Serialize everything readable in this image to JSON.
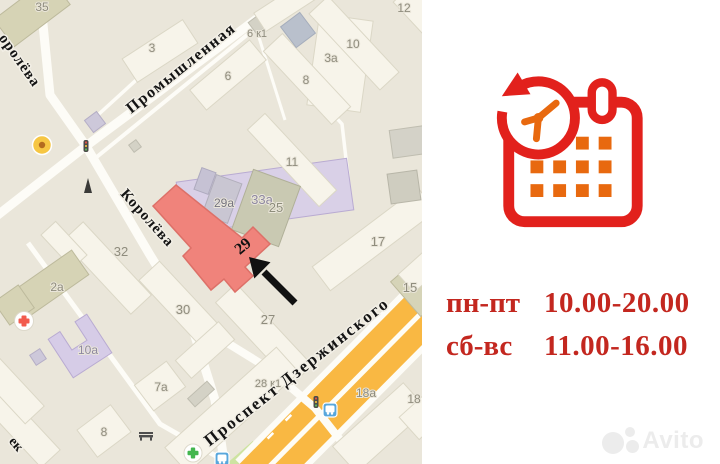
{
  "map": {
    "street_labels": [
      {
        "text": "Промышленная"
      },
      {
        "text": "Королёва"
      },
      {
        "text": "оролёва"
      },
      {
        "text": "Проспект Дзержинского"
      },
      {
        "text": "ек"
      }
    ],
    "building_labels": [
      {
        "text": "35"
      },
      {
        "text": "3а"
      },
      {
        "text": "3"
      },
      {
        "text": "6 к1"
      },
      {
        "text": "12"
      },
      {
        "text": "6"
      },
      {
        "text": "8"
      },
      {
        "text": "10"
      },
      {
        "text": "11"
      },
      {
        "text": "33а"
      },
      {
        "text": "29а"
      },
      {
        "text": "25"
      },
      {
        "text": "17"
      },
      {
        "text": "15"
      },
      {
        "text": "32"
      },
      {
        "text": "30"
      },
      {
        "text": "27"
      },
      {
        "text": "2а"
      },
      {
        "text": "10а"
      },
      {
        "text": "7а"
      },
      {
        "text": "8"
      },
      {
        "text": "28 к1"
      },
      {
        "text": "18а"
      },
      {
        "text": "18"
      }
    ],
    "highlight": {
      "label": "29",
      "color": "#f0837b"
    },
    "markers": [
      "cafe-marker",
      "monument-marker",
      "hospital-marker",
      "pharmacy-marker",
      "bus-stop-marker",
      "bus-stop-marker",
      "traffic-light-marker",
      "traffic-light-marker",
      "bench-marker"
    ],
    "colors": {
      "background": "#eae6da",
      "road": "#fdfcf7",
      "highway": "#f9b843",
      "building": "#f7f4ea",
      "green": "#cde3a1",
      "label_gray": "#8f8c7d",
      "street_label": "#141414"
    }
  },
  "hours": {
    "color": "#c3271f",
    "rows": [
      {
        "days": "пн-пт",
        "time": "10.00-20.00"
      },
      {
        "days": "сб-вс",
        "time": "11.00-16.00"
      }
    ]
  },
  "icon": {
    "name": "calendar-clock-icon",
    "red": "#e2211c",
    "orange": "#e8690f"
  },
  "watermark": {
    "text": "Avito"
  }
}
